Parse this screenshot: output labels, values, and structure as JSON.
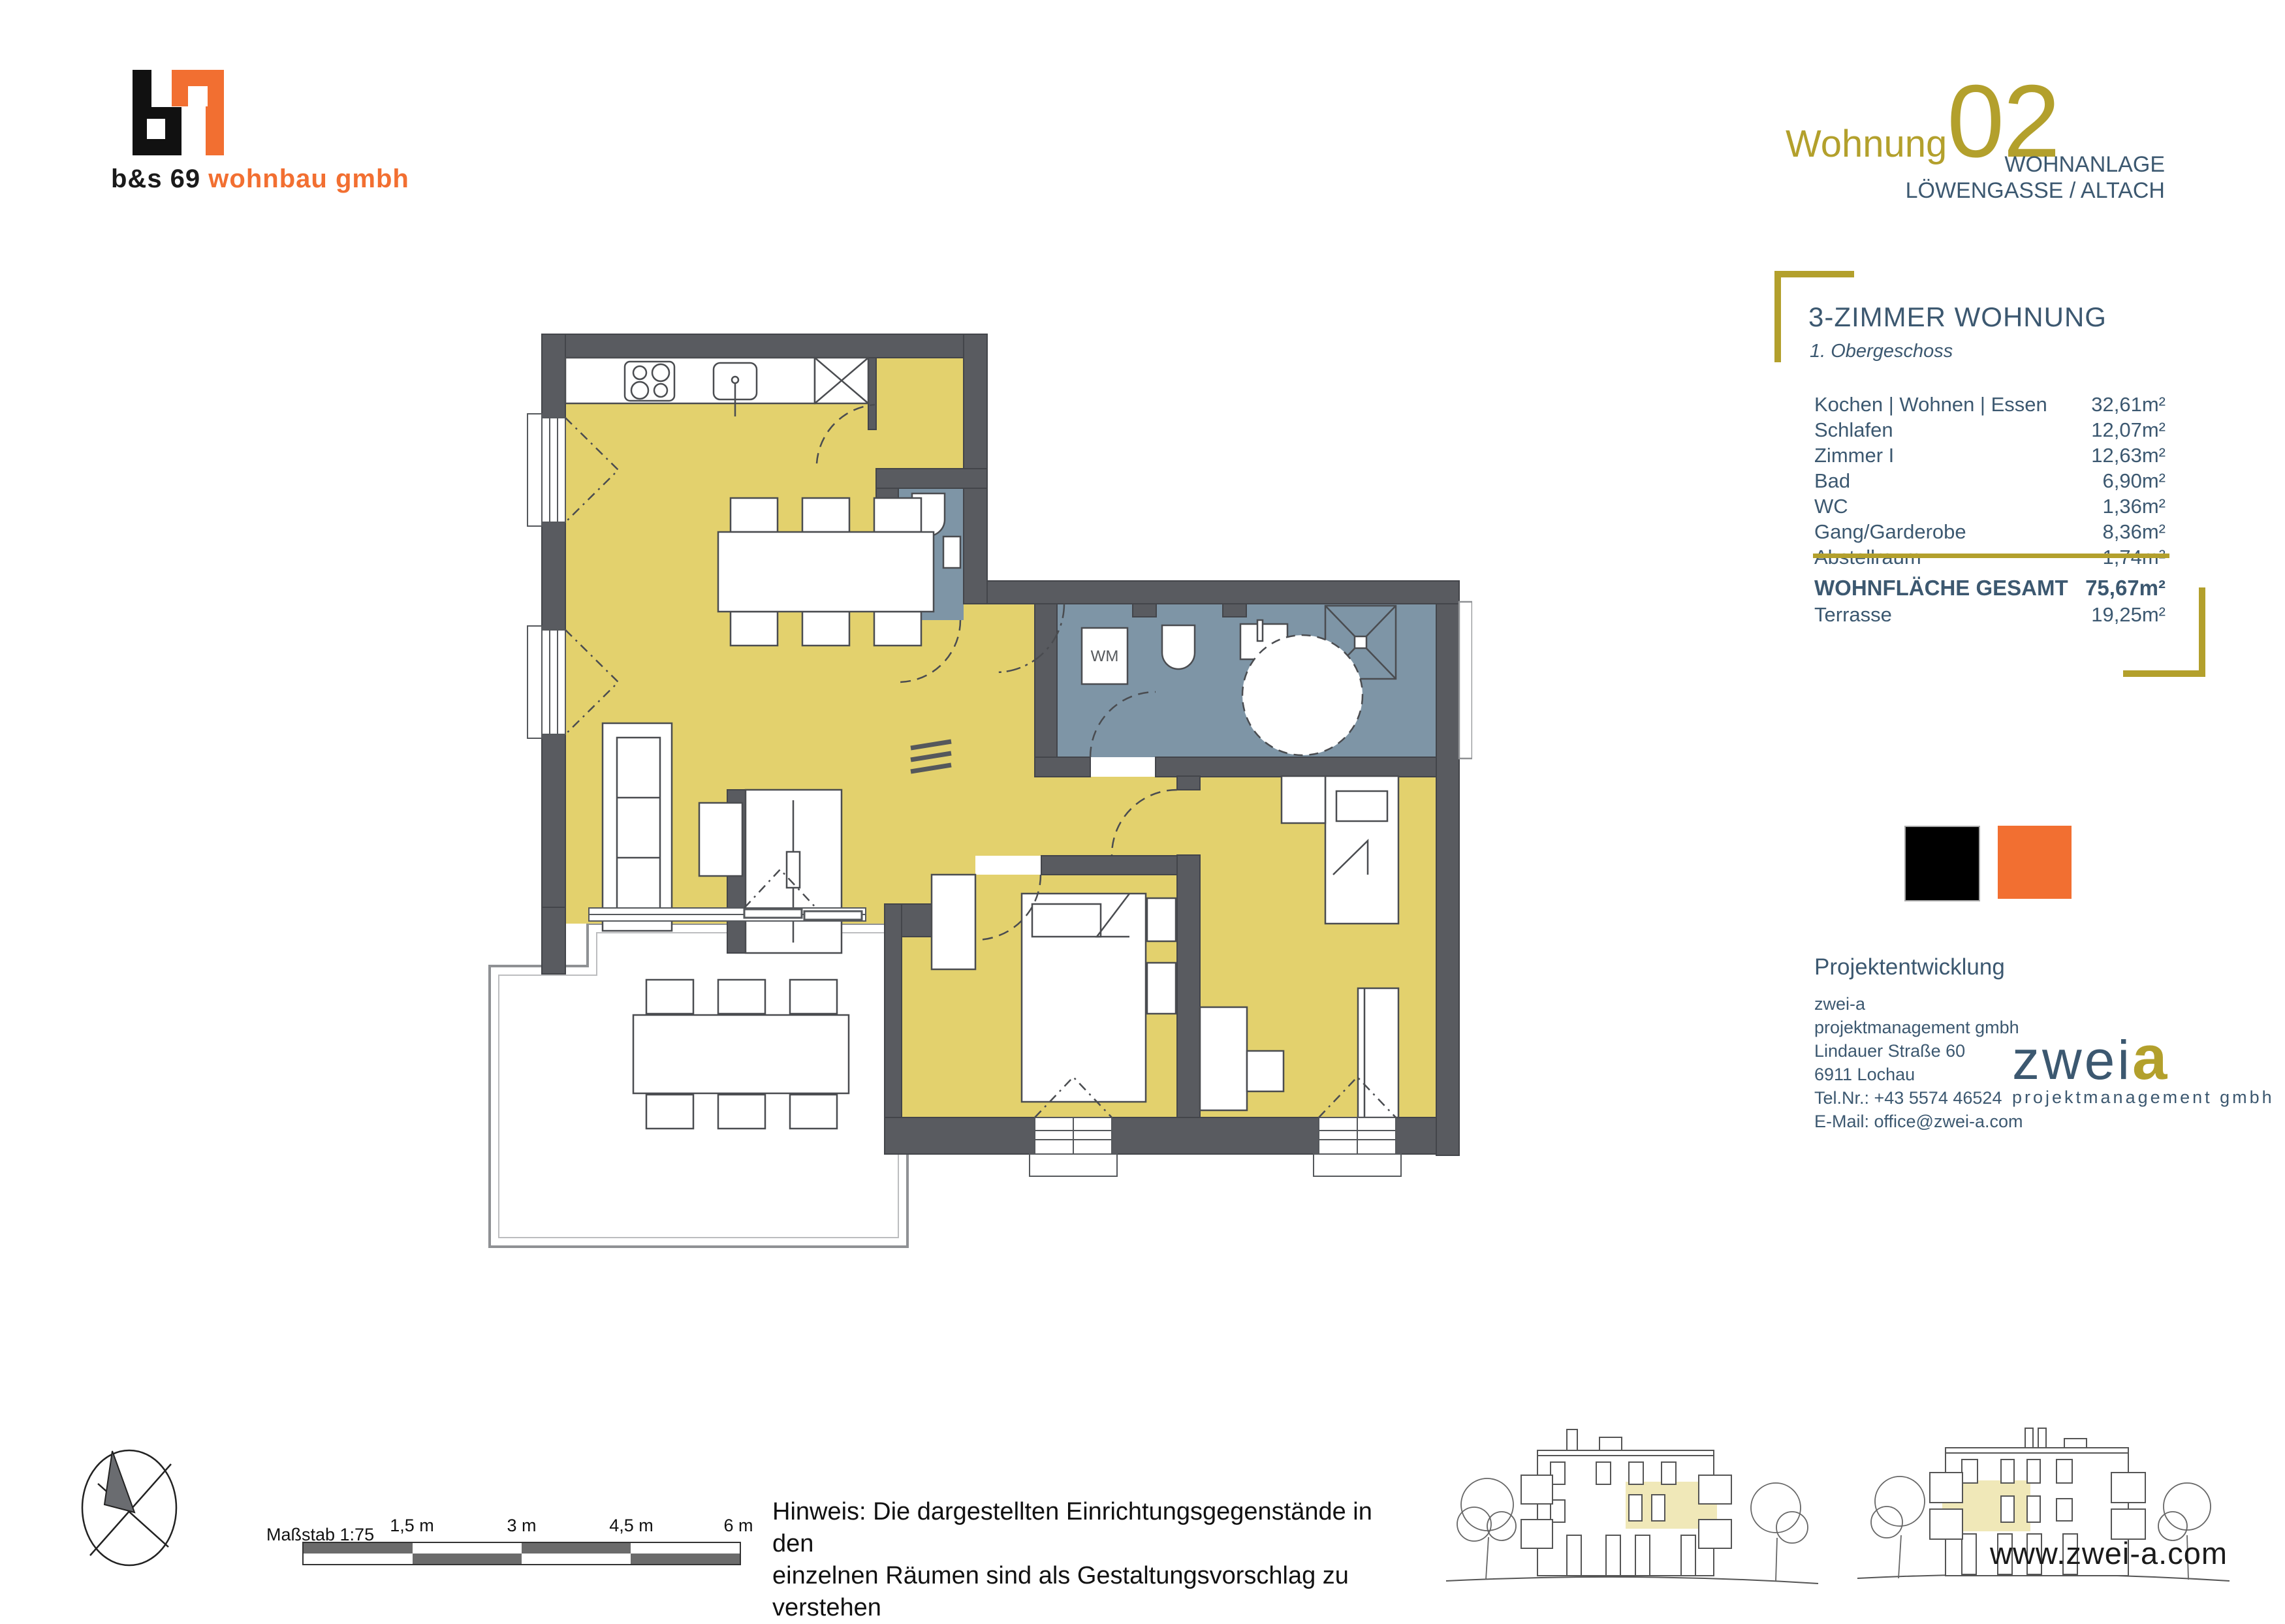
{
  "branding": {
    "logo_black_text": "b&s 69",
    "logo_orange_text": "wohnbau gmbh",
    "black": "#111111",
    "orange": "#f26f31"
  },
  "header": {
    "title_word": "Wohnung",
    "title_number": "02",
    "subtitle_line1": "WOHNANLAGE",
    "subtitle_line2": "LÖWENGASSE / ALTACH"
  },
  "info_panel": {
    "title": "3-ZIMMER WOHNUNG",
    "subtitle": "1. Obergeschoss",
    "rooms": [
      {
        "name": "Kochen | Wohnen | Essen",
        "area": "32,61m²"
      },
      {
        "name": "Schlafen",
        "area": "12,07m²"
      },
      {
        "name": "Zimmer I",
        "area": "12,63m²"
      },
      {
        "name": "Bad",
        "area": "6,90m²"
      },
      {
        "name": "WC",
        "area": "1,36m²"
      },
      {
        "name": "Gang/Garderobe",
        "area": "8,36m²"
      },
      {
        "name": "Abstellraum",
        "area": "1,74m²"
      }
    ],
    "total_label": "WOHNFLÄCHE GESAMT",
    "total_value": "75,67m²",
    "terrace_label": "Terrasse",
    "terrace_value": "19,25m²",
    "accent_gold": "#b3a02c",
    "text_blue": "#3c5870"
  },
  "plan": {
    "wm_label": "WM",
    "wall_color": "#595b60",
    "room_yellow": "#e3d16d",
    "wet_room_blue": "#7e95a6"
  },
  "contact": {
    "heading": "Projektentwicklung",
    "lines": [
      "zwei-a",
      "projektmanagement gmbh",
      "Lindauer Straße 60",
      "6911 Lochau",
      "Tel.Nr.: +43 5574 46524",
      "E-Mail: office@zwei-a.com"
    ]
  },
  "zweia_logo": {
    "word": "zwei",
    "a": "a",
    "sub": "projektmanagement gmbh"
  },
  "scalebar": {
    "label": "Maßstab 1:75",
    "ticks": [
      "1,5 m",
      "3 m",
      "4,5 m",
      "6 m"
    ]
  },
  "note": {
    "line1": "Hinweis: Die dargestellten Einrichtungsgegenstände in den",
    "line2": "einzelnen Räumen sind als Gestaltungsvorschlag zu verstehen"
  },
  "website": "www.zwei-a.com"
}
